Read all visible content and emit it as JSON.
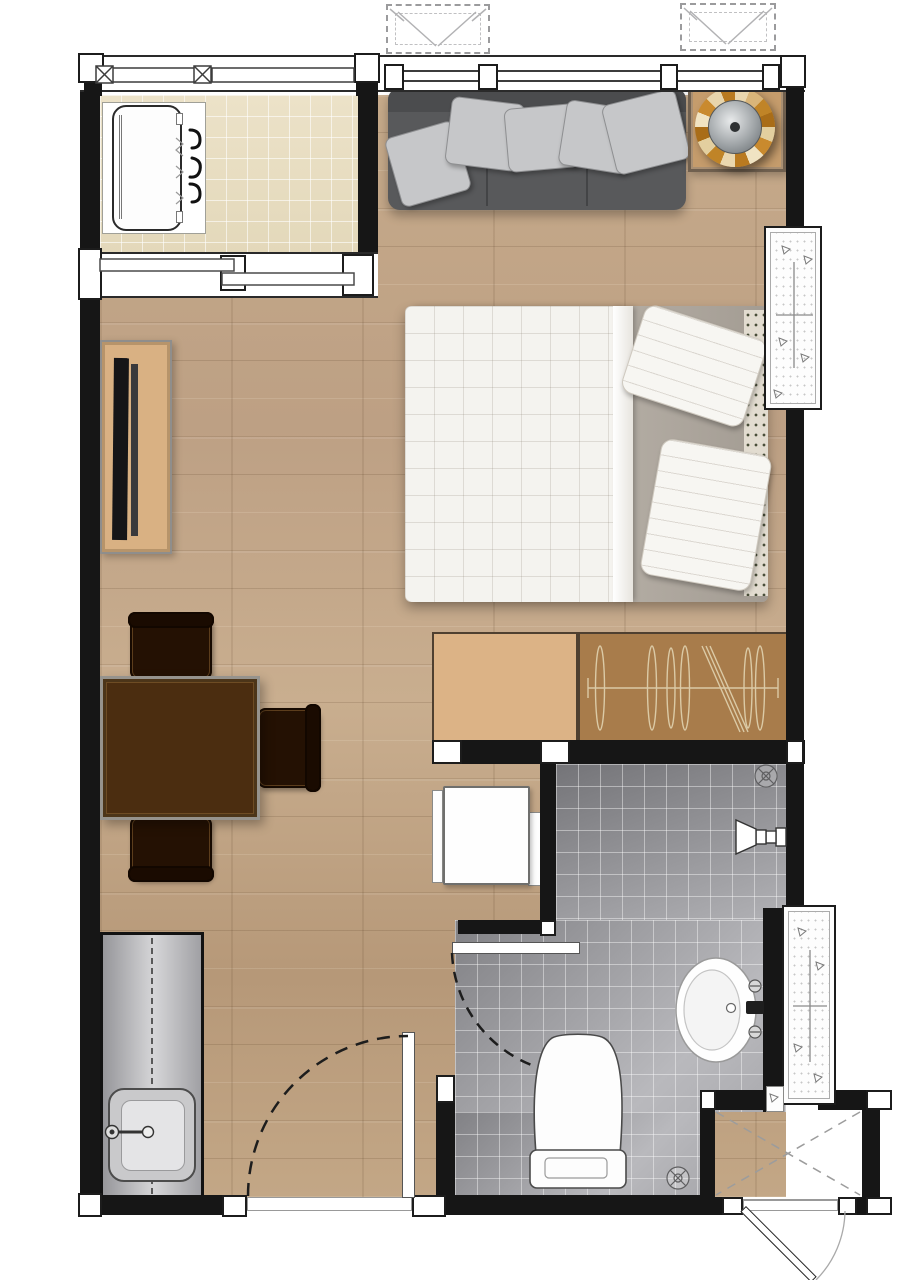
{
  "document": {
    "type": "floor-plan",
    "title": "Studio apartment floor plan (top view)",
    "canvas_px": {
      "width": 905,
      "height": 1280
    }
  },
  "palette": {
    "wall": "#161616",
    "wood_floor": "#c3a888",
    "balcony_tile": "#e7ddc1",
    "bath_tile": "#97979b",
    "sofa": "#58595b",
    "sofa_pillow": "#c6c7c9",
    "duvet": "#f4f3ef",
    "bed_sheet": "#b3aca3",
    "console_tan": "#d9b183",
    "wardrobe_brown": "#a87c4b",
    "dresser_tan": "#dcb386",
    "dining_table": "#4b2d10",
    "chair": "#241103",
    "counter_gray": "#c6c6c8",
    "fixture_white": "#fdfdfd",
    "accent_amber": "#c98a2e",
    "accent_cream": "#ead7ae"
  },
  "rooms": [
    {
      "id": "living",
      "name": "Living / sleeping area",
      "floor": "wood planks"
    },
    {
      "id": "balcony",
      "name": "Balcony",
      "floor": "beige ceramic tile"
    },
    {
      "id": "bathroom",
      "name": "Bathroom with shower",
      "floor": "gray tile"
    },
    {
      "id": "entry",
      "name": "Entry alcove",
      "floor": "bare"
    }
  ],
  "furniture": [
    {
      "id": "sofa",
      "name": "Sofa with five pillows",
      "room": "living"
    },
    {
      "id": "side-table",
      "name": "Decorative side table",
      "room": "living"
    },
    {
      "id": "bed",
      "name": "Double bed with duvet and two pillows",
      "room": "living"
    },
    {
      "id": "tv-console",
      "name": "TV console with flat-screen TV",
      "room": "living"
    },
    {
      "id": "dining-set",
      "name": "Square dining table with three chairs",
      "room": "living"
    },
    {
      "id": "dresser",
      "name": "Low dresser",
      "room": "living"
    },
    {
      "id": "wardrobe",
      "name": "Wardrobe with hanging rail",
      "room": "living"
    },
    {
      "id": "white-cabinet",
      "name": "Small white cabinet",
      "room": "living"
    },
    {
      "id": "kitchen-counter",
      "name": "Kitchen counter with sink and faucet",
      "room": "living"
    },
    {
      "id": "washing-machine",
      "name": "Washing machine on drain pad",
      "room": "balcony"
    }
  ],
  "fixtures": [
    {
      "id": "toilet",
      "name": "Toilet",
      "room": "bathroom"
    },
    {
      "id": "bath-sink",
      "name": "Wash basin with faucet",
      "room": "bathroom"
    },
    {
      "id": "shower",
      "name": "Wall shower head",
      "room": "bathroom"
    },
    {
      "id": "drain-shower",
      "name": "Floor drain (shower)",
      "room": "bathroom"
    },
    {
      "id": "drain-bath",
      "name": "Floor drain (bathroom)",
      "room": "bathroom"
    },
    {
      "id": "ac-ledge-upper",
      "name": "Concrete AC ledge upper",
      "room": "exterior"
    },
    {
      "id": "ac-ledge-lower",
      "name": "Concrete AC ledge lower",
      "room": "exterior"
    },
    {
      "id": "ac-units",
      "name": "Outdoor units (dashed outline)",
      "room": "exterior"
    }
  ],
  "openings": [
    {
      "id": "main-door",
      "name": "Room door with swing arc"
    },
    {
      "id": "bathroom-door",
      "name": "Bathroom door with swing arc"
    },
    {
      "id": "entry-door",
      "name": "Entry alcove door"
    },
    {
      "id": "sliding-door",
      "name": "Balcony sliding glass door"
    },
    {
      "id": "windows",
      "name": "Full-width windows"
    },
    {
      "id": "railing",
      "name": "Balcony railing"
    }
  ]
}
